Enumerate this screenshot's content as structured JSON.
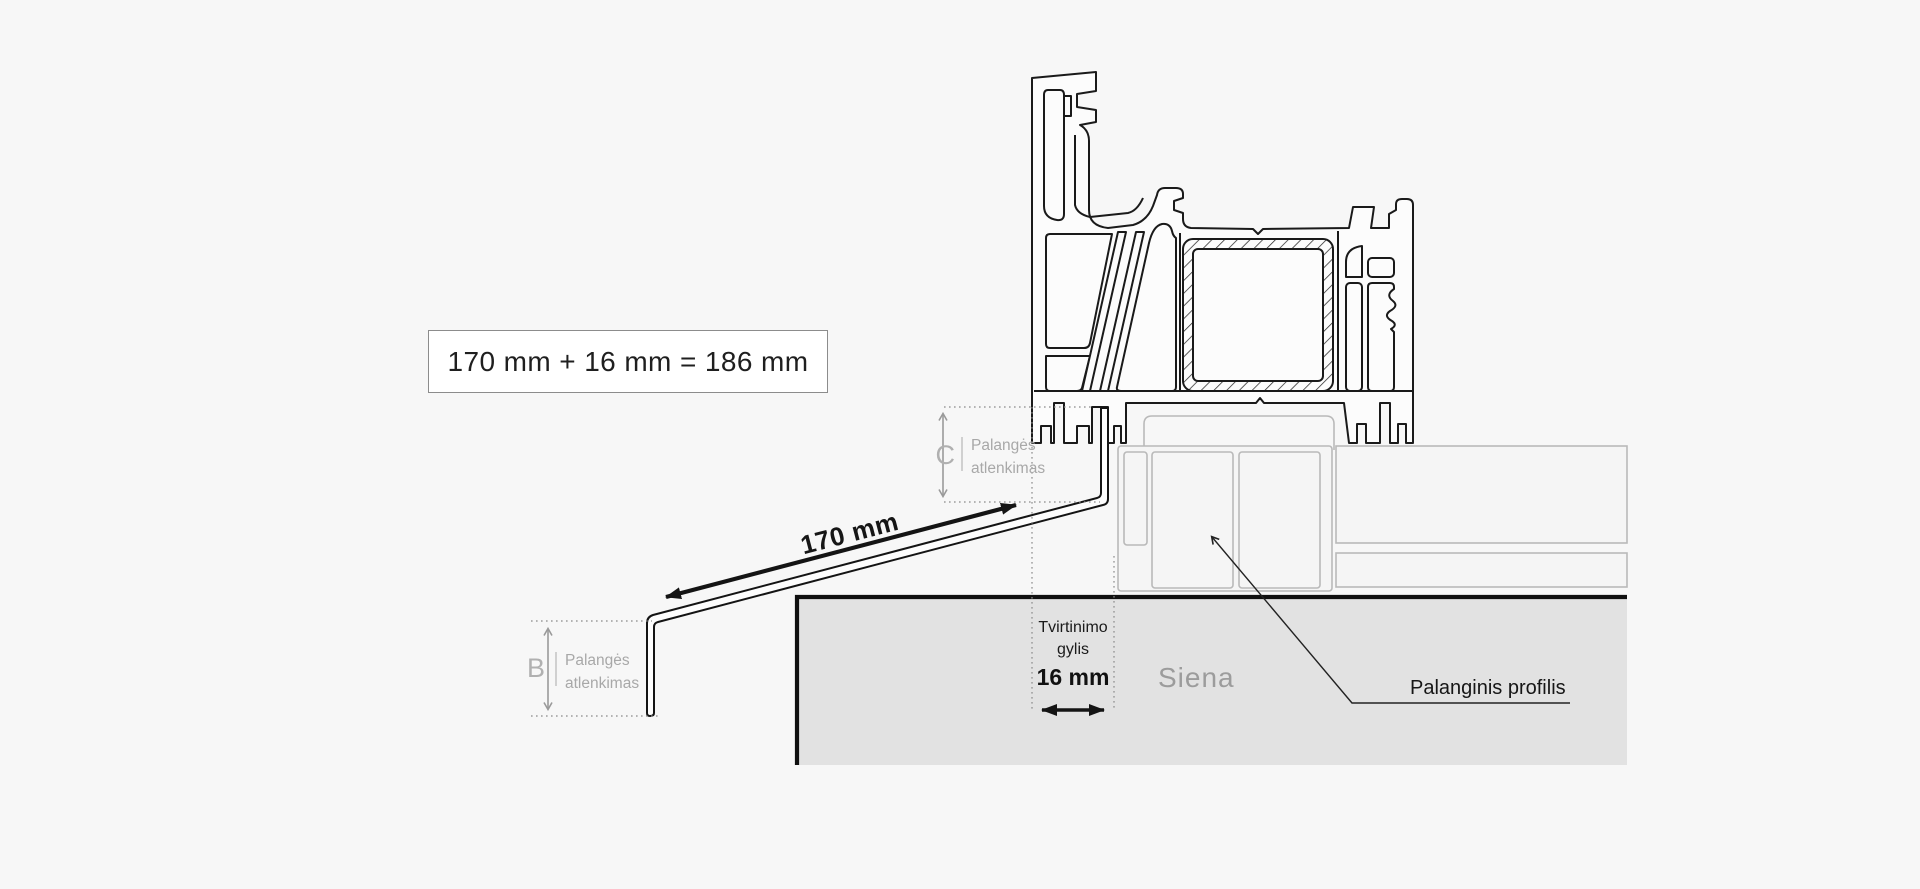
{
  "colors": {
    "background": "#f7f7f7",
    "wall_fill": "#e2e2e2",
    "outline_black": "#1a1a1a",
    "outline_gray": "#b9b9b9",
    "dimension_gray": "#9a9a9a",
    "text_gray": "#a8a8a8"
  },
  "formula_box": {
    "text": "170 mm + 16 mm = 186 mm"
  },
  "dimension_c": {
    "letter": "C",
    "label_line1": "Palangės",
    "label_line2": "atlenkimas"
  },
  "dimension_b": {
    "letter": "B",
    "label_line1": "Palangės",
    "label_line2": "atlenkimas"
  },
  "dimension_length": {
    "value": "170 mm"
  },
  "dimension_depth": {
    "label_line1": "Tvirtinimo",
    "label_line2": "gylis",
    "value": "16 mm"
  },
  "wall": {
    "label": "Siena"
  },
  "sill_profile": {
    "label": "Palanginis profilis"
  }
}
